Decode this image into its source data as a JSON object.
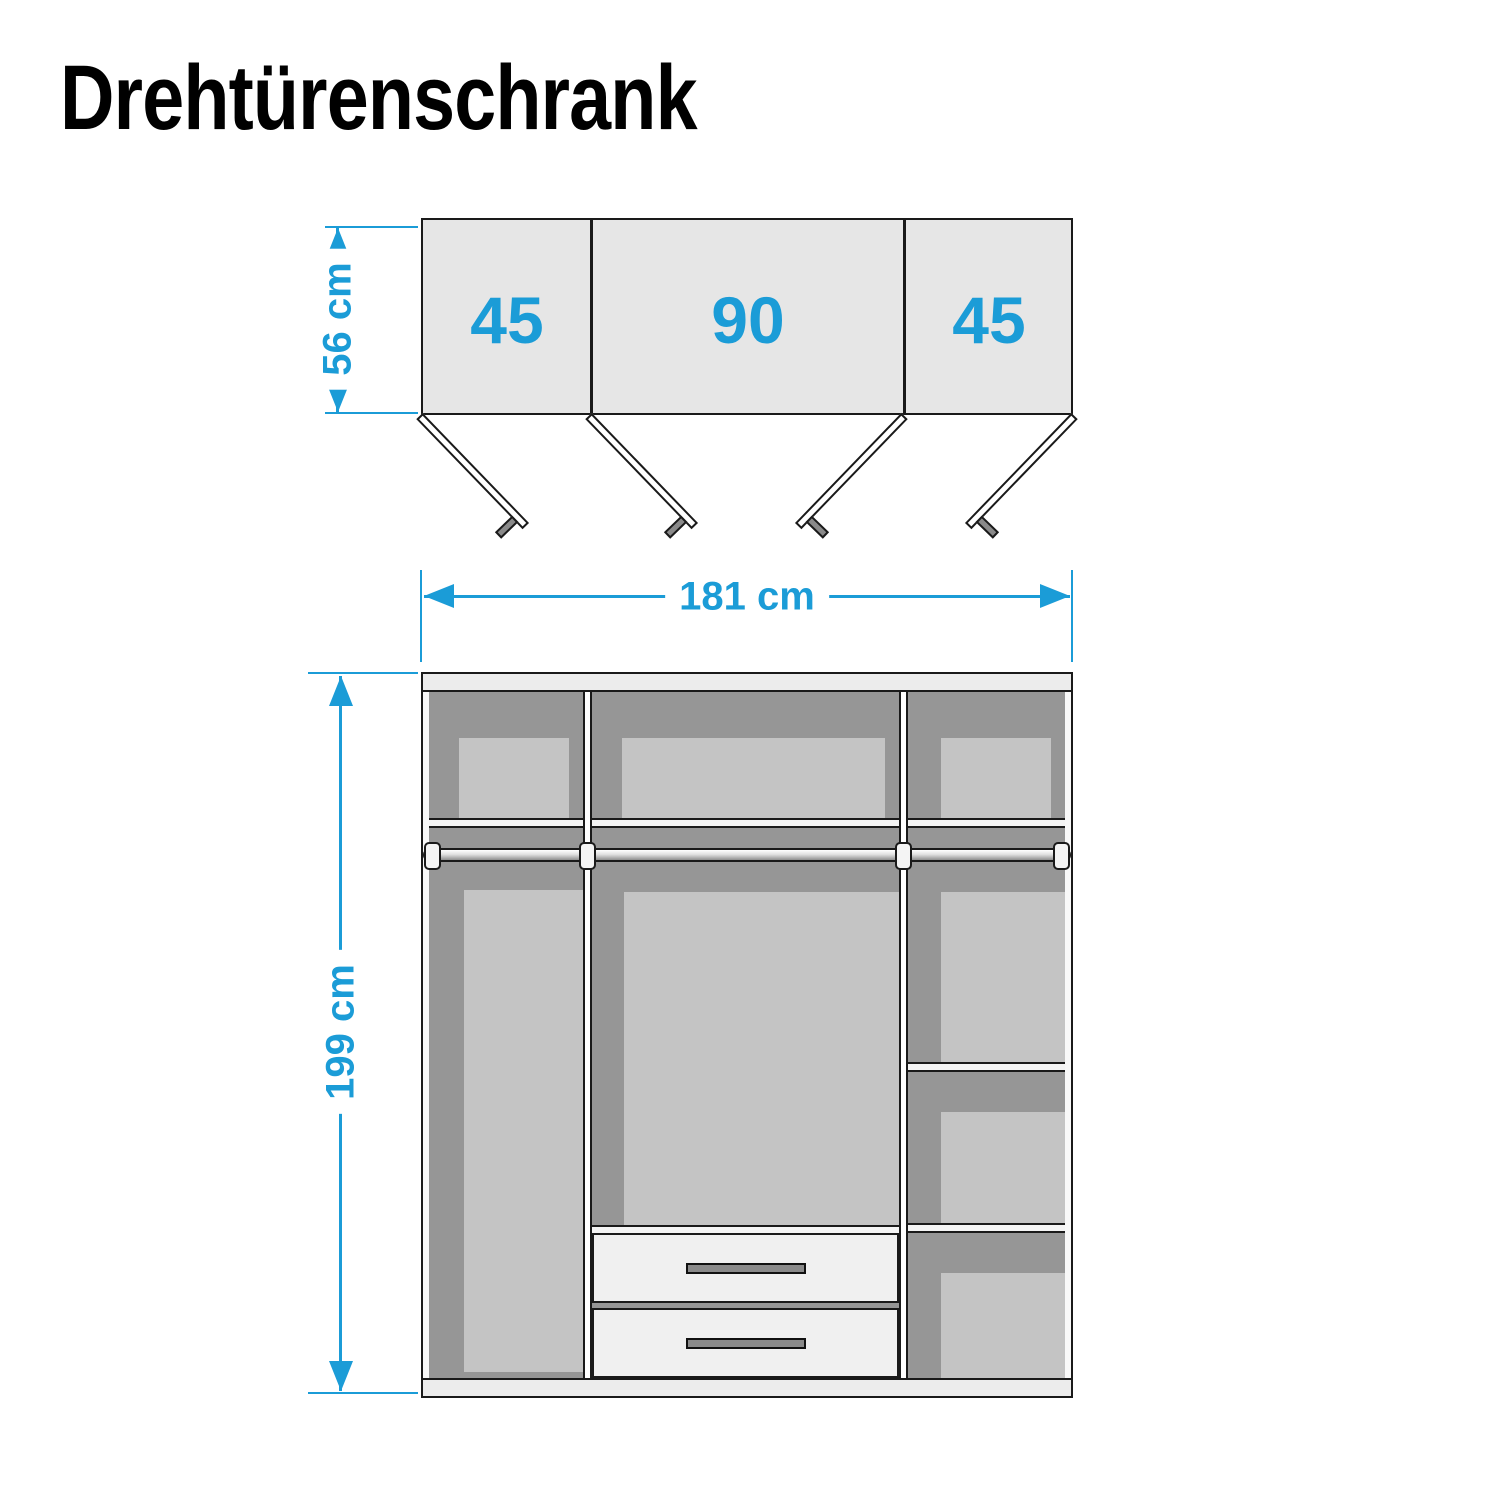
{
  "title": "Drehtürenschrank",
  "top_view": {
    "depth_label": "56 cm",
    "depth_cm": 56,
    "sections": [
      {
        "width_label": "45",
        "width_cm": 45
      },
      {
        "width_label": "90",
        "width_cm": 90
      },
      {
        "width_label": "45",
        "width_cm": 45
      }
    ],
    "door_count": 4
  },
  "dimensions": {
    "width_label": "181 cm",
    "width_cm": 181,
    "height_label": "199 cm",
    "height_cm": 199
  },
  "front_view": {
    "drawer_count": 2,
    "clothes_rail_count": 3,
    "right_column_shelf_count": 2
  },
  "colors": {
    "accent_blue": "#1B9CD7",
    "top_view_fill": "#E6E6E6",
    "interior_dark_gray": "#969696",
    "interior_light_gray": "#C4C4C4",
    "structure_white": "#F0F0F0",
    "band_gray": "#ECECEC",
    "handle_gray": "#8A8A8A",
    "outline_black": "#1A1A1A"
  }
}
